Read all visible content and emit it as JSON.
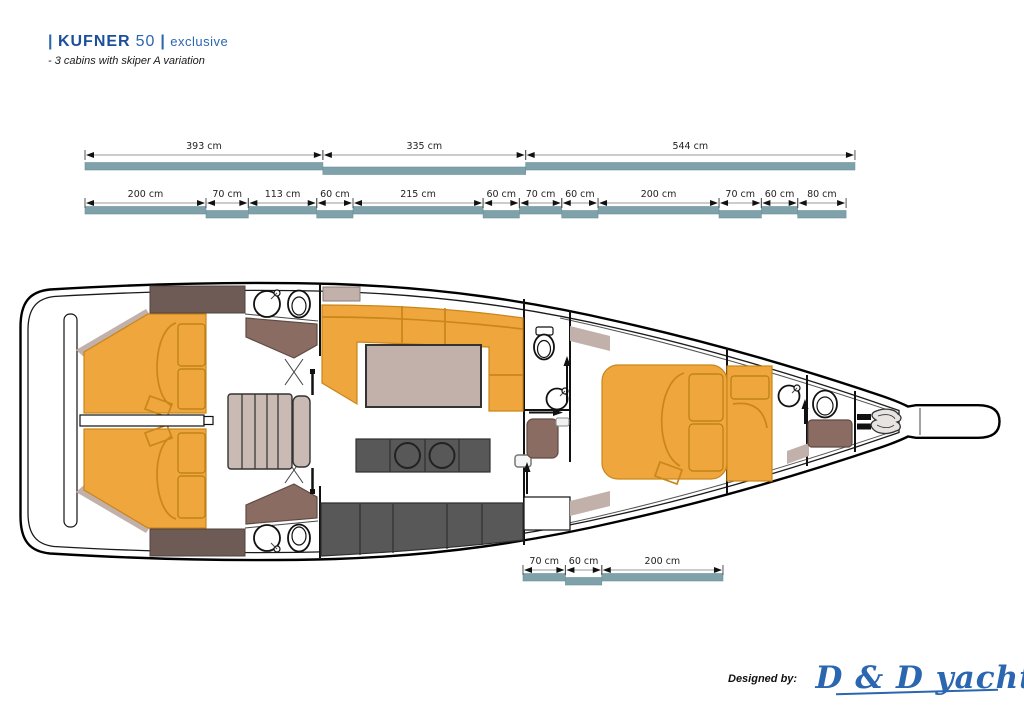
{
  "header": {
    "separator": "|",
    "brand": "KUFNER",
    "model": "50",
    "edition": "exclusive",
    "subtitle": "- 3 cabins with skiper A variation"
  },
  "dimensions": {
    "unit": "cm",
    "row1": [
      {
        "cm": 393,
        "label": "393 cm"
      },
      {
        "cm": 335,
        "label": "335 cm"
      },
      {
        "cm": 544,
        "label": "544 cm"
      }
    ],
    "row2": [
      {
        "cm": 200,
        "label": "200 cm"
      },
      {
        "cm": 70,
        "label": "70 cm"
      },
      {
        "cm": 113,
        "label": "113 cm"
      },
      {
        "cm": 60,
        "label": "60 cm"
      },
      {
        "cm": 215,
        "label": "215 cm"
      },
      {
        "cm": 60,
        "label": "60 cm"
      },
      {
        "cm": 70,
        "label": "70 cm"
      },
      {
        "cm": 60,
        "label": "60 cm"
      },
      {
        "cm": 200,
        "label": "200 cm"
      },
      {
        "cm": 70,
        "label": "70 cm"
      },
      {
        "cm": 60,
        "label": "60 cm"
      },
      {
        "cm": 80,
        "label": "80 cm"
      }
    ],
    "row3": [
      {
        "cm": 70,
        "label": "70 cm"
      },
      {
        "cm": 60,
        "label": "60 cm"
      },
      {
        "cm": 200,
        "label": "200 cm"
      }
    ]
  },
  "footer": {
    "designed_by": "Designed by:",
    "studio": "D & D yachts"
  },
  "colors": {
    "accent-blue": "#2b66b0",
    "brand-blue": "#1b4e9b",
    "bed-orange": "#efa63c",
    "teal-bar": "#7fa2aa",
    "taupe": "#c2b1aa",
    "stairs-taupe": "#c9bab4",
    "dark-wood": "#6f5b56",
    "shower-brown": "#8a6c62",
    "galley-gray": "#585858"
  }
}
